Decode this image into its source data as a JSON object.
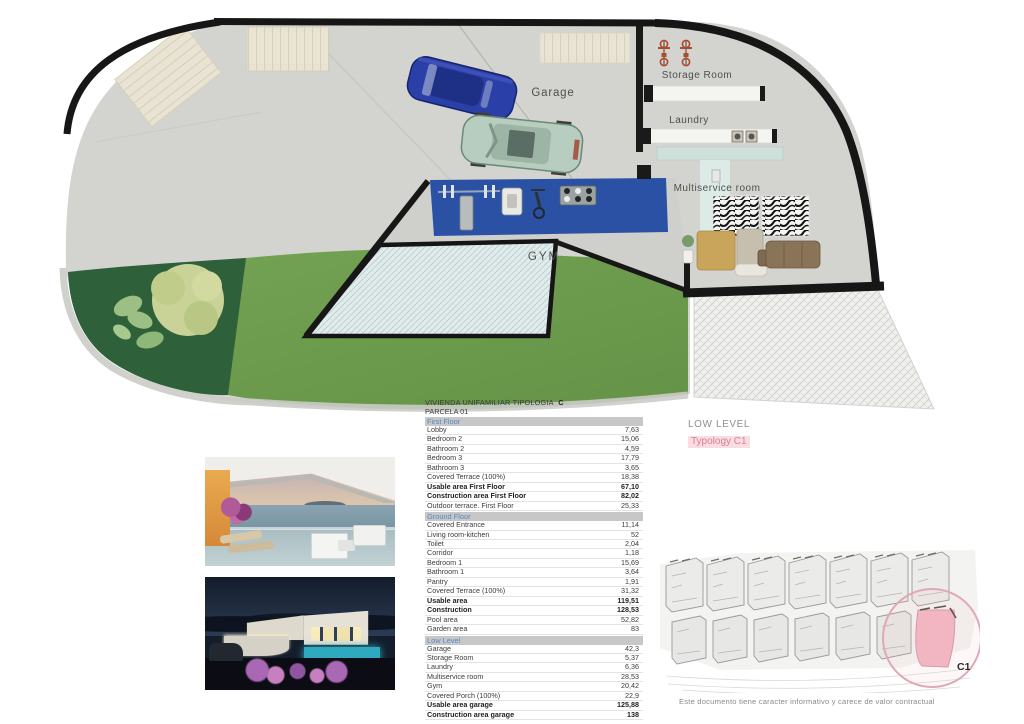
{
  "plan": {
    "labels": {
      "garage": "Garage",
      "gym": "GYM",
      "storage": "Storage Room",
      "laundry": "Laundry",
      "multiservice": "Multiservice room"
    },
    "colors": {
      "lawn": "#6f9d4e",
      "planting_bed": "#2e6039",
      "gym_mat": "#2b51a5",
      "wall": "#191919",
      "concrete": "#d3d3cf",
      "hatch_fill": "#e3ecec"
    }
  },
  "legend": {
    "level": "LOW LEVEL",
    "typology": "Typology C1"
  },
  "areas": {
    "title": "VIVIENDA UNIFAMILIAR TIPOLOGIA",
    "title_letter": "C",
    "subtitle": "PARCELA  01",
    "sections": [
      {
        "header": "First Floor",
        "rows": [
          {
            "label": "Lobby",
            "value": "7,63"
          },
          {
            "label": "Bedroom 2",
            "value": "15,06"
          },
          {
            "label": "Bathroom 2",
            "value": "4,59"
          },
          {
            "label": "Bedroom 3",
            "value": "17,79"
          },
          {
            "label": "Bathroom 3",
            "value": "3,65"
          },
          {
            "label": "Covered Terrace (100%)",
            "value": "18,38"
          },
          {
            "label": "Usable area First Floor",
            "value": "67,10",
            "bold": true
          },
          {
            "label": "Construction area First Floor",
            "value": "82,02",
            "bold": true
          },
          {
            "label": "Outdoor terrace.  First Floor",
            "value": "25,33"
          }
        ]
      },
      {
        "header": "Ground Floor",
        "rows": [
          {
            "label": "Covered Entrance",
            "value": "11,14"
          },
          {
            "label": "Living room-kitchen",
            "value": "52"
          },
          {
            "label": "Toilet",
            "value": "2,04"
          },
          {
            "label": "Corridor",
            "value": "1,18"
          },
          {
            "label": "Bedroom 1",
            "value": "15,69"
          },
          {
            "label": "Bathroom 1",
            "value": "3,64"
          },
          {
            "label": "Pantry",
            "value": "1,91"
          },
          {
            "label": "Covered Terrace (100%)",
            "value": "31,32"
          },
          {
            "label": "Usable area",
            "value": "119,51",
            "bold": true
          },
          {
            "label": "Construction",
            "value": "128,53",
            "bold": true
          },
          {
            "label": "Pool area",
            "value": "52,82"
          },
          {
            "label": "Garden area",
            "value": "83"
          }
        ]
      },
      {
        "header": "Low Level",
        "rows": [
          {
            "label": "Garage",
            "value": "42,3"
          },
          {
            "label": "Storage Room",
            "value": "5,37"
          },
          {
            "label": "Laundry",
            "value": "6,36"
          },
          {
            "label": "Multiservice room",
            "value": "28,53"
          },
          {
            "label": "Gym",
            "value": "20,42"
          },
          {
            "label": "Covered Porch (100%)",
            "value": "22,9"
          },
          {
            "label": "Usable area garage",
            "value": "125,88",
            "bold": true
          },
          {
            "label": "Construction area garage",
            "value": "138",
            "bold": true
          }
        ]
      }
    ],
    "totals": [
      {
        "label": "USABLE AREA TOTAL",
        "value": "312,49",
        "bold": true
      },
      {
        "label": "CONSTRUCTION AREA TOTAL",
        "value": "348,55",
        "bold": true
      }
    ]
  },
  "siteplan": {
    "unit_label": "C1",
    "caption": "Este documento tiene caracter informativo y carece de valor contractual"
  },
  "photos": [
    {
      "name": "terrace-sea-view-render"
    },
    {
      "name": "villa-night-render"
    }
  ]
}
